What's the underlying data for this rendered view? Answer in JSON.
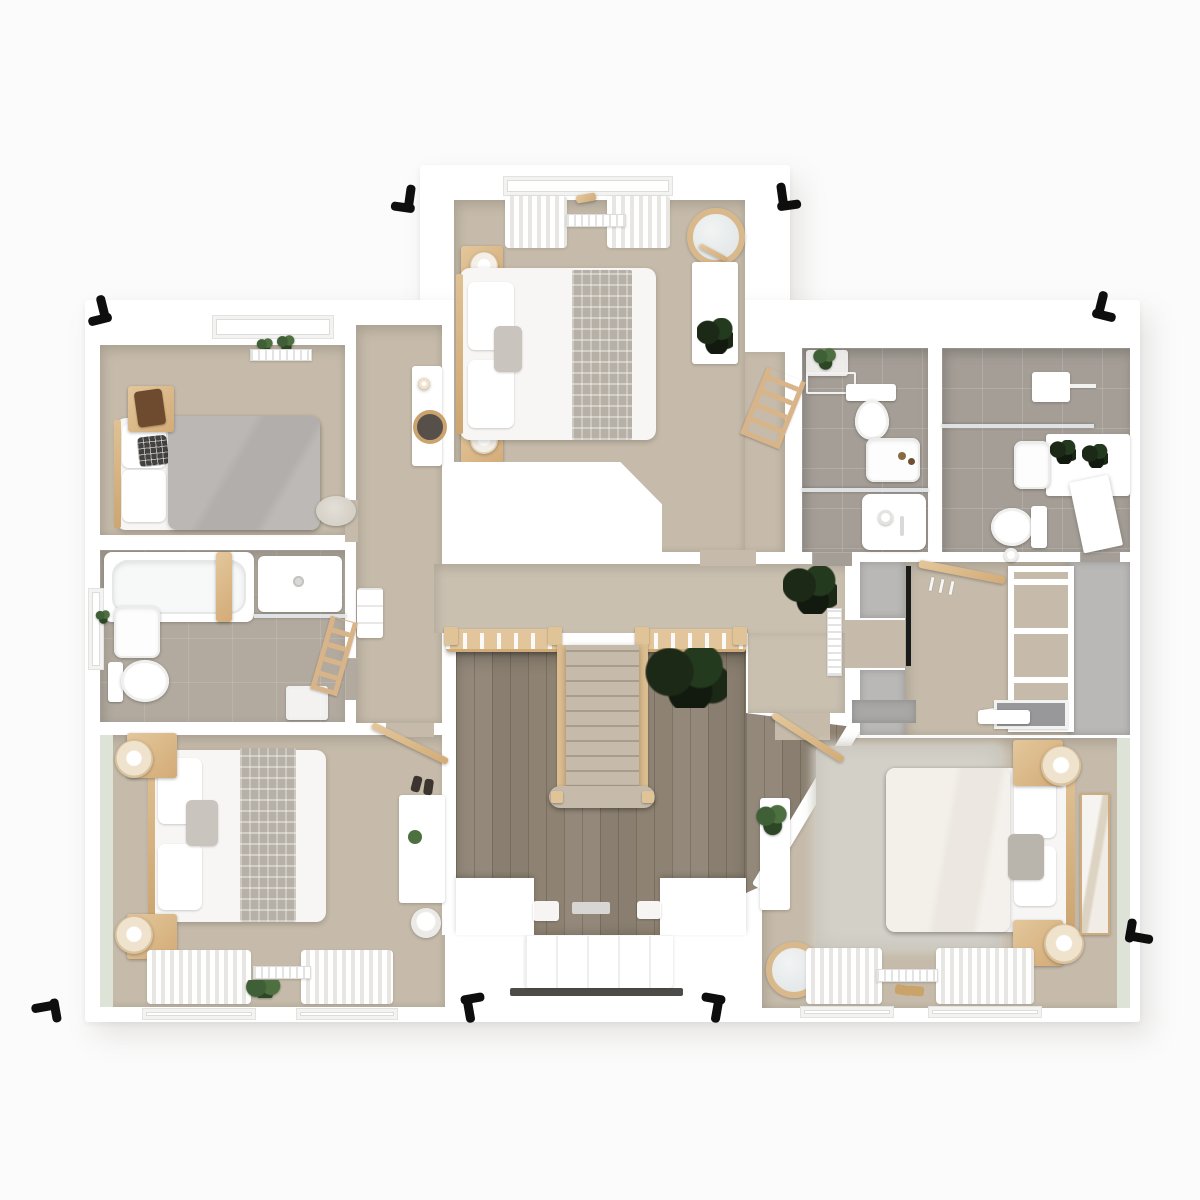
{
  "scene": {
    "kind": "3d-floor-plan-render",
    "floor_label": "upper floor",
    "view": "top-down"
  },
  "palette": {
    "bg": "#fbfbfb",
    "wall": "#ffffff",
    "carpet": "#c6bbaa",
    "carpet2": "#cac0b0",
    "tile_cool": "#a49e96",
    "tile_warm": "#b2aa9f",
    "wood_floor": "#8c8172",
    "wood_light": "#e3c79b",
    "wood_mid": "#d3ab77",
    "runner": "#b7b0a7",
    "sage": "#dde3d7",
    "plant": "#3f5f36",
    "plant_dark": "#1c2917",
    "black": "#0e0e0e"
  },
  "rooms": [
    {
      "id": "bedroom-top",
      "name": "bedroom 1",
      "floor": "beige carpet",
      "items": [
        "double-bed",
        "runner",
        "pillows",
        "nightstand x2",
        "table-lamp x2",
        "curtains",
        "radiator",
        "cheval-mirror",
        "console-table",
        "plant",
        "ladder-shelf",
        "stair-bulkhead"
      ]
    },
    {
      "id": "corridor",
      "name": "corridor",
      "floor": "beige carpet",
      "items": [
        "console-table",
        "round-mirror",
        "drawer-cabinet"
      ]
    },
    {
      "id": "bedroom-left",
      "name": "bedroom 3",
      "floor": "beige carpet",
      "items": [
        "single-bed",
        "gray-duvet",
        "knit-pillow",
        "nightstand",
        "throw-blanket",
        "pouf",
        "radiator",
        "window-plants"
      ]
    },
    {
      "id": "bathroom-left",
      "name": "family bathroom",
      "floor": "warm tile",
      "items": [
        "bathtub",
        "bath-caddy",
        "walk-in-shower",
        "washbasin",
        "toilet",
        "stool",
        "towel-ladder",
        "window-plant"
      ]
    },
    {
      "id": "bathroom-mid",
      "name": "shower room",
      "floor": "gray tile",
      "items": [
        "toilet",
        "washbasin",
        "shower-tray",
        "plant-shelf",
        "towel-rack"
      ]
    },
    {
      "id": "bathroom-right",
      "name": "ensuite bathroom",
      "floor": "gray tile",
      "items": [
        "shower-enclosure",
        "shower-head",
        "vanity-counter",
        "plants x2",
        "washbasin",
        "toilet",
        "door-leaf"
      ]
    },
    {
      "id": "landing",
      "name": "landing",
      "floor": "beige carpet",
      "items": [
        "balustrade",
        "newel-posts",
        "radiator",
        "plant-alocasia"
      ]
    },
    {
      "id": "stairwell",
      "name": "stairwell void",
      "floor": "wood planks (ground floor below)",
      "items": [
        "staircase",
        "curtail-step",
        "ground-plant",
        "doormats",
        "front-door",
        "threshold"
      ]
    },
    {
      "id": "dressing",
      "name": "walk-in wardrobe",
      "floor": "beige carpet",
      "items": [
        "hanging-rail",
        "hangers",
        "shelf-unit",
        "corner-shelf",
        "wardrobe-blocks",
        "mirror-strip"
      ]
    },
    {
      "id": "bedroom-bottom-left",
      "name": "bedroom 2",
      "floor": "beige carpet + sage wall",
      "items": [
        "double-bed",
        "runner",
        "nightstand x2",
        "table-lamp x2",
        "desk",
        "chair",
        "clothes-rail",
        "shoes",
        "curtains x2",
        "radiator",
        "window-plant"
      ]
    },
    {
      "id": "bedroom-bottom-right",
      "name": "master bedroom",
      "floor": "beige carpet + sage wall",
      "items": [
        "double-bed",
        "shag-rug",
        "nightstand x2",
        "table-lamp x2",
        "artwork",
        "wardrobe-tops",
        "wall-mirror",
        "floating-shelf",
        "console-table",
        "plant",
        "round-mirror",
        "clothes-rail",
        "slippers",
        "curtains x2",
        "radiator"
      ]
    },
    {
      "id": "exterior",
      "name": "exterior",
      "items": [
        "downpipe-brackets x8",
        "porch-canopy",
        "entrance-door"
      ]
    }
  ]
}
